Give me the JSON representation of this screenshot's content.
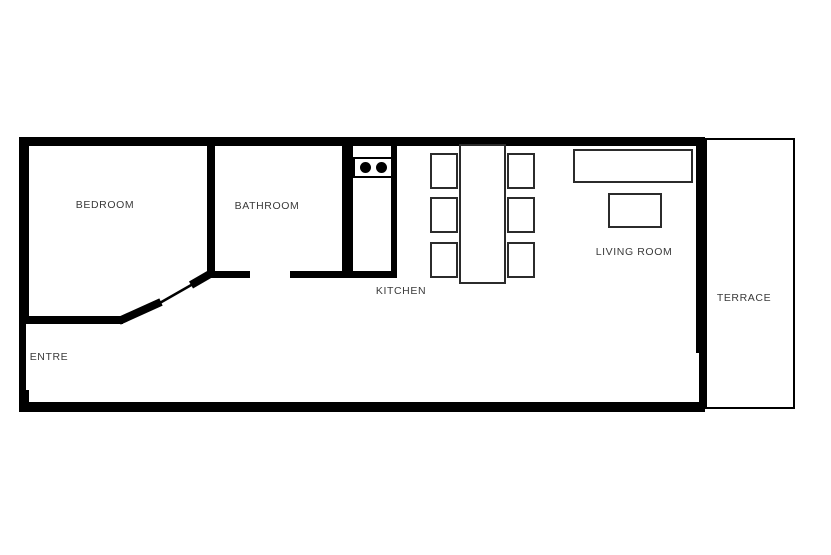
{
  "title": "Apartment floor plan",
  "colors": {
    "wall": "#000000",
    "furniture_outline": "#2b2b2b",
    "background": "#ffffff",
    "label_text": "#3a3a3a"
  },
  "rooms": [
    {
      "id": "bedroom",
      "label": "BEDROOM"
    },
    {
      "id": "bathroom",
      "label": "BATHROOM"
    },
    {
      "id": "kitchen",
      "label": "KITCHEN"
    },
    {
      "id": "living-room",
      "label": "LIVING ROOM"
    },
    {
      "id": "terrace",
      "label": "TERRACE"
    },
    {
      "id": "entre",
      "label": "ENTRE"
    }
  ],
  "furniture": {
    "kitchen": [
      "counter",
      "stove-two-burners"
    ],
    "dining": [
      "table",
      "chair x6"
    ],
    "living_room": [
      "sofa",
      "coffee-table"
    ]
  },
  "doors": [
    "bedroom-angled-door",
    "bathroom-door-opening",
    "terrace-opening"
  ]
}
